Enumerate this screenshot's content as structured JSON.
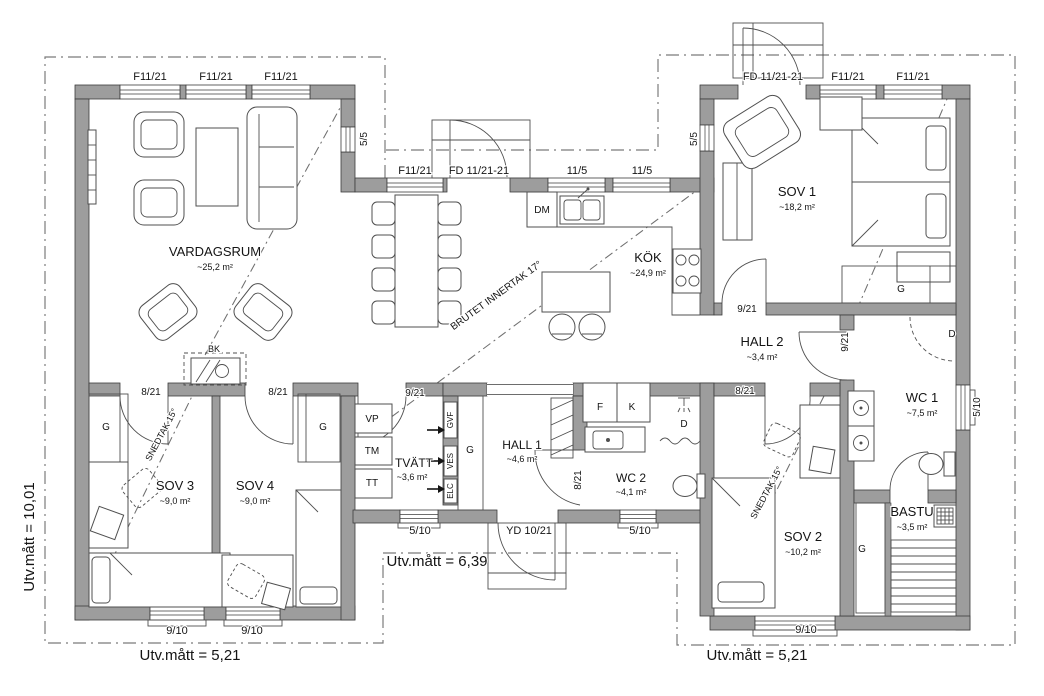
{
  "title": "Floor plan (Swedish house plan)",
  "colors": {
    "wall_fill": "#9d9d9d",
    "wall_stroke": "#3c3c3c",
    "boundary": "#7b7b7b",
    "text": "#141414"
  },
  "measurements": {
    "left_vertical": "Utv.mått = 10,01",
    "bottom_middle": "Utv.mått = 6,39",
    "bottom_left": "Utv.mått = 5,21",
    "bottom_right": "Utv.mått = 5,21"
  },
  "rooms": [
    {
      "name": "VARDAGSRUM",
      "area": "~25,2 m²"
    },
    {
      "name": "KÖK",
      "area": "~24,9 m²"
    },
    {
      "name": "SOV 1",
      "area": "~18,2 m²"
    },
    {
      "name": "HALL 2",
      "area": "~3,4 m²"
    },
    {
      "name": "WC 1",
      "area": "~7,5 m²"
    },
    {
      "name": "SOV 2",
      "area": "~10,2 m²"
    },
    {
      "name": "BASTU",
      "area": "~3,5 m²"
    },
    {
      "name": "SOV 3",
      "area": "~9,0 m²"
    },
    {
      "name": "SOV 4",
      "area": "~9,0 m²"
    },
    {
      "name": "TVÄTT",
      "area": "~3,6 m²"
    },
    {
      "name": "HALL 1",
      "area": "~4,6 m²"
    },
    {
      "name": "WC 2",
      "area": "~4,1 m²"
    }
  ],
  "labels": [
    {
      "id": "window-label-f1121-a",
      "text": "F11/21",
      "x": 150,
      "y": 80,
      "size": 11
    },
    {
      "id": "window-label-f1121-b",
      "text": "F11/21",
      "x": 216,
      "y": 80,
      "size": 11
    },
    {
      "id": "window-label-f1121-c",
      "text": "F11/21",
      "x": 281,
      "y": 80,
      "size": 11
    },
    {
      "id": "window-label-55-left",
      "text": "5/5",
      "x": 367,
      "y": 139,
      "size": 10,
      "rotate": -90
    },
    {
      "id": "window-label-f1121-mid",
      "text": "F11/21",
      "x": 415,
      "y": 174,
      "size": 11
    },
    {
      "id": "door-label-fd-mid",
      "text": "FD 11/21-21",
      "x": 479,
      "y": 174,
      "size": 11
    },
    {
      "id": "window-label-115-a",
      "text": "11/5",
      "x": 577,
      "y": 174,
      "size": 11
    },
    {
      "id": "window-label-115-b",
      "text": "11/5",
      "x": 642,
      "y": 174,
      "size": 11
    },
    {
      "id": "window-label-55-right",
      "text": "5/5",
      "x": 697,
      "y": 139,
      "size": 10,
      "rotate": -90
    },
    {
      "id": "door-label-fd-right",
      "text": "FD 11/21-21",
      "x": 773,
      "y": 80,
      "size": 11
    },
    {
      "id": "window-label-f1121-d",
      "text": "F11/21",
      "x": 848,
      "y": 80,
      "size": 11
    },
    {
      "id": "window-label-f1121-e",
      "text": "F11/21",
      "x": 913,
      "y": 80,
      "size": 11
    },
    {
      "id": "room-label-vardagsrum",
      "text": "VARDAGSRUM",
      "x": 215,
      "y": 256,
      "size": 13
    },
    {
      "id": "area-label-vardagsrum",
      "text": "~25,2 m²",
      "x": 215,
      "y": 270,
      "size": 9
    },
    {
      "id": "room-label-kok",
      "text": "KÖK",
      "x": 648,
      "y": 262,
      "size": 13
    },
    {
      "id": "area-label-kok",
      "text": "~24,9 m²",
      "x": 648,
      "y": 276,
      "size": 9
    },
    {
      "id": "room-label-sov1",
      "text": "SOV 1",
      "x": 797,
      "y": 196,
      "size": 13
    },
    {
      "id": "area-label-sov1",
      "text": "~18,2 m²",
      "x": 797,
      "y": 210,
      "size": 9
    },
    {
      "id": "room-label-hall2",
      "text": "HALL 2",
      "x": 762,
      "y": 346,
      "size": 13
    },
    {
      "id": "area-label-hall2",
      "text": "~3,4 m²",
      "x": 762,
      "y": 360,
      "size": 9
    },
    {
      "id": "room-label-wc1",
      "text": "WC 1",
      "x": 922,
      "y": 402,
      "size": 13
    },
    {
      "id": "area-label-wc1",
      "text": "~7,5 m²",
      "x": 922,
      "y": 416,
      "size": 9
    },
    {
      "id": "room-label-sov2",
      "text": "SOV 2",
      "x": 803,
      "y": 541,
      "size": 13
    },
    {
      "id": "area-label-sov2",
      "text": "~10,2 m²",
      "x": 803,
      "y": 555,
      "size": 9
    },
    {
      "id": "room-label-bastu",
      "text": "BASTU",
      "x": 912,
      "y": 516,
      "size": 13
    },
    {
      "id": "area-label-bastu",
      "text": "~3,5 m²",
      "x": 912,
      "y": 530,
      "size": 9
    },
    {
      "id": "room-label-sov3",
      "text": "SOV 3",
      "x": 175,
      "y": 490,
      "size": 13
    },
    {
      "id": "area-label-sov3",
      "text": "~9,0 m²",
      "x": 175,
      "y": 504,
      "size": 9
    },
    {
      "id": "room-label-sov4",
      "text": "SOV 4",
      "x": 255,
      "y": 490,
      "size": 13
    },
    {
      "id": "area-label-sov4",
      "text": "~9,0 m²",
      "x": 255,
      "y": 504,
      "size": 9
    },
    {
      "id": "room-label-tvatt",
      "text": "TVÄTT",
      "x": 414,
      "y": 467,
      "size": 12
    },
    {
      "id": "area-label-tvatt",
      "text": "~3,6 m²",
      "x": 412,
      "y": 480,
      "size": 9
    },
    {
      "id": "room-label-hall1",
      "text": "HALL 1",
      "x": 522,
      "y": 449,
      "size": 12
    },
    {
      "id": "area-label-hall1",
      "text": "~4,6 m²",
      "x": 522,
      "y": 462,
      "size": 9
    },
    {
      "id": "room-label-wc2",
      "text": "WC 2",
      "x": 631,
      "y": 482,
      "size": 12
    },
    {
      "id": "area-label-wc2",
      "text": "~4,1 m²",
      "x": 631,
      "y": 495,
      "size": 9
    },
    {
      "id": "door-label-sov3",
      "text": "8/21",
      "x": 151,
      "y": 395,
      "size": 10
    },
    {
      "id": "door-label-sov4",
      "text": "8/21",
      "x": 278,
      "y": 395,
      "size": 10
    },
    {
      "id": "door-label-tvatt",
      "text": "9/21",
      "x": 415,
      "y": 396,
      "size": 10
    },
    {
      "id": "door-label-sov1",
      "text": "9/21",
      "x": 747,
      "y": 312,
      "size": 10
    },
    {
      "id": "door-label-sov2",
      "text": "8/21",
      "x": 745,
      "y": 394,
      "size": 10
    },
    {
      "id": "door-label-wc1",
      "text": "9/21",
      "x": 848,
      "y": 342,
      "size": 10,
      "rotate": -90
    },
    {
      "id": "door-label-wc2",
      "text": "8/21",
      "x": 581,
      "y": 480,
      "size": 10,
      "rotate": -90
    },
    {
      "id": "window-label-510-a",
      "text": "5/10",
      "x": 420,
      "y": 534,
      "size": 11
    },
    {
      "id": "door-label-yd",
      "text": "YD 10/21",
      "x": 529,
      "y": 534,
      "size": 11
    },
    {
      "id": "window-label-510-b",
      "text": "5/10",
      "x": 640,
      "y": 534,
      "size": 11
    },
    {
      "id": "window-label-910-a",
      "text": "9/10",
      "x": 177,
      "y": 634,
      "size": 11
    },
    {
      "id": "window-label-910-b",
      "text": "9/10",
      "x": 252,
      "y": 634,
      "size": 11
    },
    {
      "id": "window-label-910-c",
      "text": "9/10",
      "x": 806,
      "y": 633,
      "size": 11
    },
    {
      "id": "window-label-510-wc1",
      "text": "5/10",
      "x": 980,
      "y": 407,
      "size": 10,
      "rotate": -90
    },
    {
      "id": "appliance-label-dm",
      "text": "DM",
      "x": 542,
      "y": 213,
      "size": 10
    },
    {
      "id": "fireplace-label-bk",
      "text": "BK",
      "x": 214,
      "y": 352,
      "size": 9
    },
    {
      "id": "closet-label-g-sov3",
      "text": "G",
      "x": 106,
      "y": 430,
      "size": 10
    },
    {
      "id": "closet-label-g-sov4",
      "text": "G",
      "x": 323,
      "y": 430,
      "size": 10
    },
    {
      "id": "closet-label-g-hall1",
      "text": "G",
      "x": 470,
      "y": 453,
      "size": 10
    },
    {
      "id": "closet-label-g-sov1",
      "text": "G",
      "x": 901,
      "y": 292,
      "size": 10
    },
    {
      "id": "closet-label-g-sov2",
      "text": "G",
      "x": 862,
      "y": 552,
      "size": 10
    },
    {
      "id": "appliance-label-f",
      "text": "F",
      "x": 600,
      "y": 410,
      "size": 10
    },
    {
      "id": "appliance-label-k",
      "text": "K",
      "x": 632,
      "y": 410,
      "size": 10
    },
    {
      "id": "shower-label-d-wc2",
      "text": "D",
      "x": 684,
      "y": 427,
      "size": 10
    },
    {
      "id": "shower-label-d-wc1",
      "text": "D",
      "x": 952,
      "y": 337,
      "size": 10
    },
    {
      "id": "appliance-label-vp",
      "text": "VP",
      "x": 372,
      "y": 422,
      "size": 10
    },
    {
      "id": "appliance-label-tm",
      "text": "TM",
      "x": 372,
      "y": 454,
      "size": 10
    },
    {
      "id": "appliance-label-tt",
      "text": "TT",
      "x": 372,
      "y": 486,
      "size": 10
    },
    {
      "id": "tech-label-gvf",
      "text": "GVF",
      "x": 453,
      "y": 420,
      "size": 8,
      "rotate": -90
    },
    {
      "id": "tech-label-ves",
      "text": "VES",
      "x": 453,
      "y": 461,
      "size": 8,
      "rotate": -90
    },
    {
      "id": "tech-label-elc",
      "text": "ELC",
      "x": 453,
      "y": 491,
      "size": 8,
      "rotate": -90
    },
    {
      "id": "ceiling-label-brutet",
      "text": "BRUTET INNERTAK 17°",
      "x": 498,
      "y": 298,
      "size": 10,
      "rotate": -36
    },
    {
      "id": "ceiling-label-snedtak-left",
      "text": "SNEDTAK 15°",
      "x": 164,
      "y": 436,
      "size": 9,
      "rotate": -62
    },
    {
      "id": "ceiling-label-snedtak-right",
      "text": "SNEDTAK 15°",
      "x": 769,
      "y": 494,
      "size": 9,
      "rotate": -62
    },
    {
      "id": "measure-label-left",
      "text": "Utv.mått = 10,01",
      "x": 34,
      "y": 537,
      "size": 15,
      "rotate": -90
    },
    {
      "id": "measure-label-mid",
      "text": "Utv.mått = 6,39",
      "x": 437,
      "y": 566,
      "size": 15
    },
    {
      "id": "measure-label-bottom-left",
      "text": "Utv.mått = 5,21",
      "x": 190,
      "y": 660,
      "size": 15
    },
    {
      "id": "measure-label-bottom-right",
      "text": "Utv.mått = 5,21",
      "x": 757,
      "y": 660,
      "size": 15
    }
  ],
  "arrows": [
    {
      "id": "arrow-gvf",
      "x": 427,
      "y": 430
    },
    {
      "id": "arrow-ves",
      "x": 427,
      "y": 461
    },
    {
      "id": "arrow-elc",
      "x": 427,
      "y": 489
    }
  ]
}
